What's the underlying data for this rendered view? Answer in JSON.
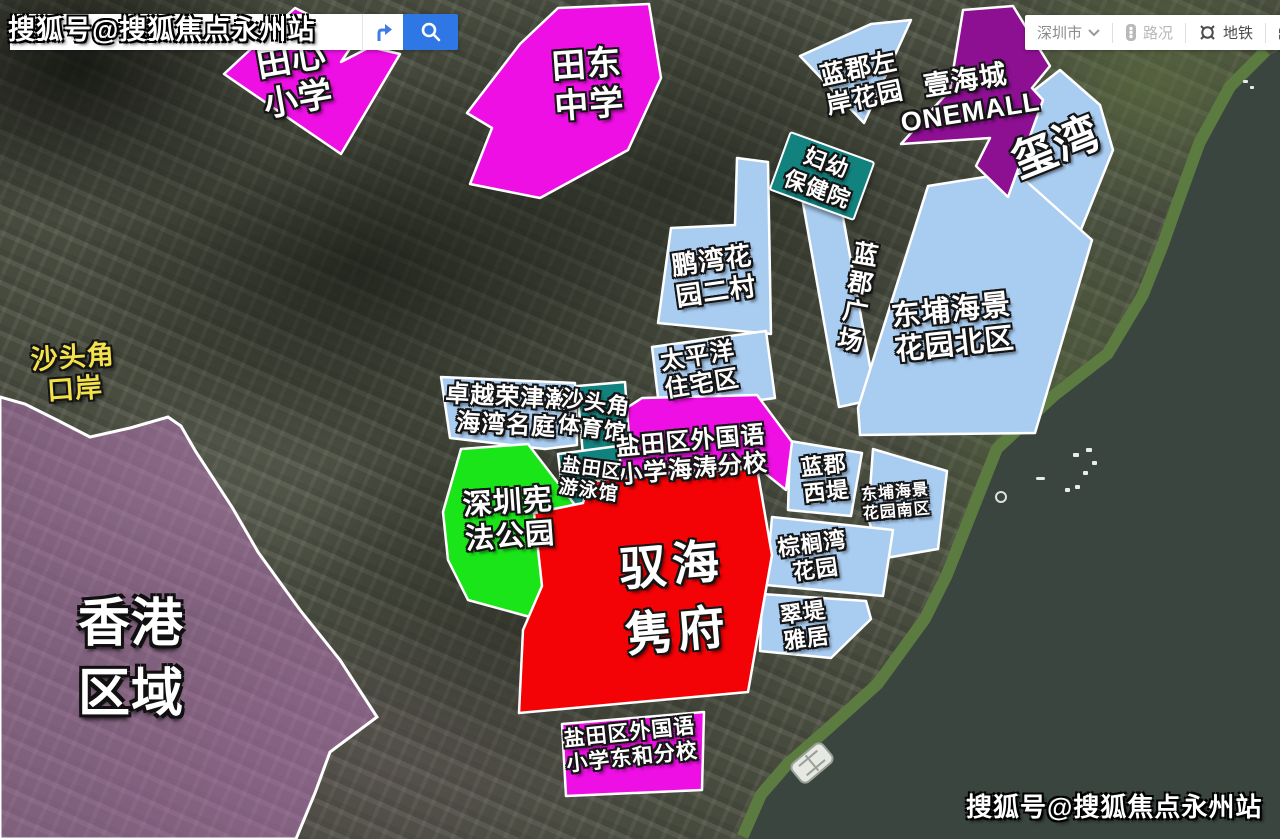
{
  "watermarks": {
    "top_left": "搜狐号@搜狐焦点永州站",
    "bottom_right": "搜狐号@搜狐焦点永州站"
  },
  "search": {
    "value": "",
    "placeholder": ""
  },
  "toolbar": {
    "city": "深圳市",
    "traffic": "路况",
    "metro": "地铁",
    "tools": "工具"
  },
  "colors": {
    "parcel_magenta": "#ed0fe3",
    "parcel_blue": "#a9cdf1",
    "parcel_purple": "#8d0f92",
    "parcel_teal": "#12827f",
    "parcel_green": "#1ae519",
    "parcel_red": "#f40306",
    "hongkong_tint": "#d882dd",
    "water": "#3a453f",
    "coast_green": "#5c7b41",
    "label_yellow": "#f3e24b",
    "search_button_blue": "#2e77e5"
  },
  "labels": {
    "tianxin_primary": {
      "l1": "田心",
      "l2": "小学"
    },
    "tiandong_middle": {
      "l1": "田东",
      "l2": "中学"
    },
    "lanjun_zuoan": {
      "l1": "蓝郡左",
      "l2": "岸花园"
    },
    "yihaicheng": {
      "l1": "壹海城",
      "l2": "ONEMALL"
    },
    "xiwan": {
      "l1": "玺湾"
    },
    "fuyou_hospital": {
      "l1": "妇幼",
      "l2": "保健院"
    },
    "pengwan_village": {
      "l1": "鹏湾花",
      "l2": "园二村"
    },
    "lanjun_plaza": {
      "l1": "蓝郡广场"
    },
    "dongpu_north": {
      "l1": "东埔海景",
      "l2": "花园北区"
    },
    "taipingyang": {
      "l1": "太平洋",
      "l2": "住宅区"
    },
    "zhuoyue": {
      "l1": "卓越荣津瀚",
      "l2": "海湾名庭"
    },
    "shatoujiao_gym": {
      "l1": "沙头角",
      "l2": "体育馆"
    },
    "haitao_school": {
      "l1": "盐田区外国语",
      "l2": "小学海涛分校"
    },
    "yantian_swim": {
      "l1": "盐田区",
      "l2": "游泳馆"
    },
    "xianfa_park": {
      "l1": "深圳宪",
      "l2": "法公园"
    },
    "yuhai_mansion": {
      "l1": "驭海",
      "l2": "隽府"
    },
    "lanjun_west": {
      "l1": "蓝郡",
      "l2": "西堤"
    },
    "dongpu_south": {
      "l1": "东埔海景",
      "l2": "花园南区"
    },
    "zonglvwan": {
      "l1": "棕榈湾",
      "l2": "花园"
    },
    "cuidi": {
      "l1": "翠堤",
      "l2": "雅居"
    },
    "donghe_school": {
      "l1": "盐田区外国语",
      "l2": "小学东和分校"
    },
    "shatoujiao_port": {
      "l1": "沙头角",
      "l2": "口岸"
    },
    "hongkong": {
      "l1": "香港",
      "l2": "区域"
    }
  }
}
